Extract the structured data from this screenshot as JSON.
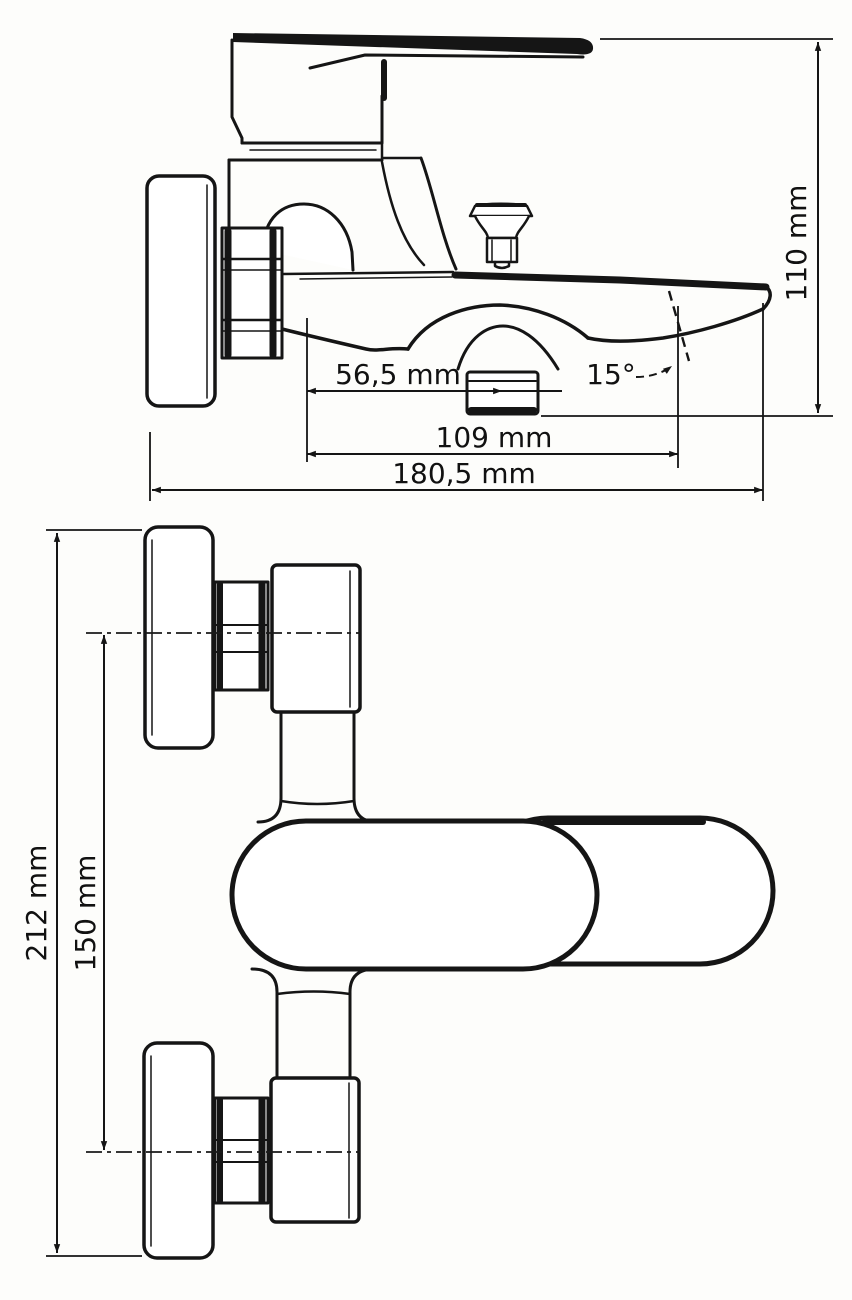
{
  "drawing": {
    "colors": {
      "ink": "#151515",
      "background": "#fdfdfb"
    },
    "views": {
      "side": {
        "dimensions": {
          "height": "110 mm",
          "spout_center_offset": "56,5 mm",
          "spout_angle": "15°",
          "spout_reach": "109 mm",
          "overall_depth": "180,5 mm"
        }
      },
      "front": {
        "dimensions": {
          "overall_height": "212 mm",
          "connection_spacing": "150 mm"
        }
      }
    }
  }
}
